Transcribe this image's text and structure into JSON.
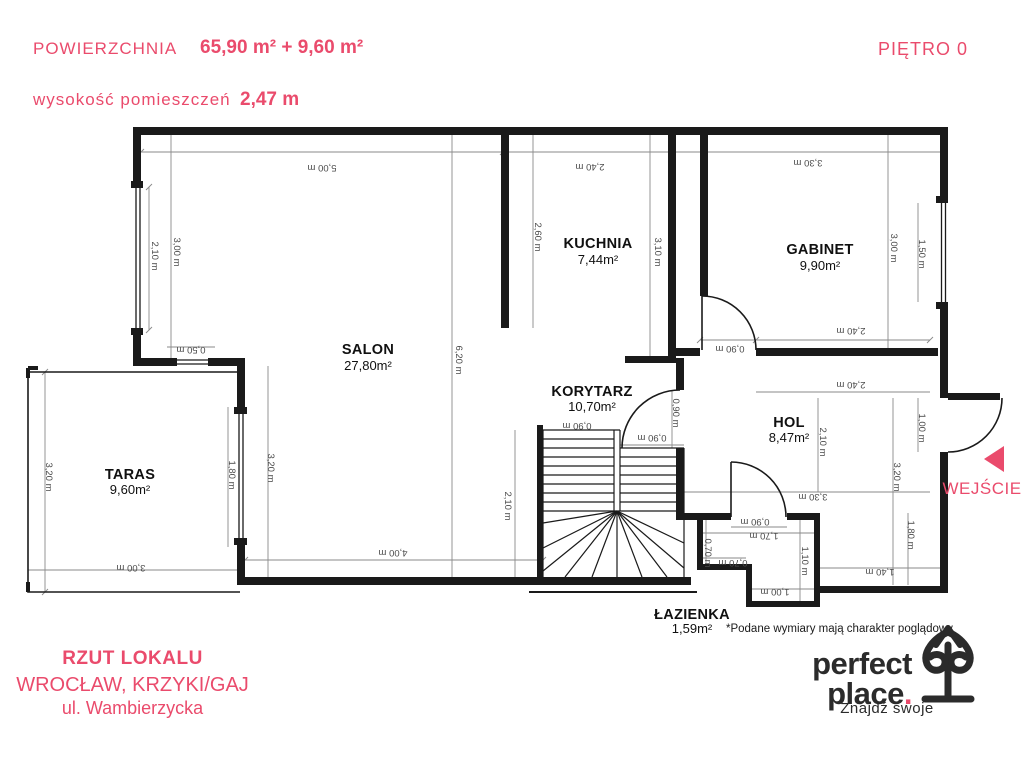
{
  "header": {
    "area_label": "POWIERZCHNIA",
    "area_value": "65,90 m² + 9,60 m²",
    "height_label": "wysokość pomieszczeń",
    "height_value": "2,47 m",
    "floor": "PIĘTRO 0"
  },
  "rooms": [
    {
      "name": "SALON",
      "area": "27,80m²"
    },
    {
      "name": "KUCHNIA",
      "area": "7,44m²"
    },
    {
      "name": "GABINET",
      "area": "9,90m²"
    },
    {
      "name": "KORYTARZ",
      "area": "10,70m²"
    },
    {
      "name": "HOL",
      "area": "8,47m²"
    },
    {
      "name": "TARAS",
      "area": "9,60m²"
    },
    {
      "name": "ŁAZIENKA",
      "area": "1,59m²"
    }
  ],
  "entrance_label": "WEJŚCIE",
  "note": "*Podane wymiary mają charakter poglądowy",
  "footer": {
    "title": "RZUT LOKALU",
    "city": "WROCŁAW, KRZYKI/GAJ",
    "street": "ul. Wambierzycka"
  },
  "logo": {
    "word1": "perfect",
    "word2": "place",
    "dot": ".",
    "tagline": "Znajdź swoje"
  },
  "colors": {
    "accent": "#ea4b6c",
    "ink": "#1a1a1a",
    "dim_lines": "#777777"
  },
  "dimensions": [
    {
      "text": "5,00 m"
    },
    {
      "text": "2,40 m"
    },
    {
      "text": "3,30 m"
    },
    {
      "text": "2,10 m"
    },
    {
      "text": "3,00 m"
    },
    {
      "text": "0,50 m"
    },
    {
      "text": "3,20 m"
    },
    {
      "text": "1,80 m"
    },
    {
      "text": "3,00 m"
    },
    {
      "text": "3,20 m"
    },
    {
      "text": "4,00 m"
    },
    {
      "text": "6,20 m"
    },
    {
      "text": "2,10 m"
    },
    {
      "text": "2,60 m"
    },
    {
      "text": "3,10 m"
    },
    {
      "text": "3,00 m"
    },
    {
      "text": "1,50 m"
    },
    {
      "text": "0,90 m"
    },
    {
      "text": "2,40 m"
    },
    {
      "text": "2,40 m"
    },
    {
      "text": "0,90 m"
    },
    {
      "text": "0,90 m"
    },
    {
      "text": "0,90 m"
    },
    {
      "text": "2,10 m"
    },
    {
      "text": "3,20 m"
    },
    {
      "text": "1,00 m"
    },
    {
      "text": "3,30 m"
    },
    {
      "text": "0,90 m"
    },
    {
      "text": "1,70 m"
    },
    {
      "text": "0,70 m"
    },
    {
      "text": "0,70 m"
    },
    {
      "text": "1,10 m"
    },
    {
      "text": "1,00 m"
    },
    {
      "text": "1,40 m"
    },
    {
      "text": "1,80 m"
    }
  ]
}
